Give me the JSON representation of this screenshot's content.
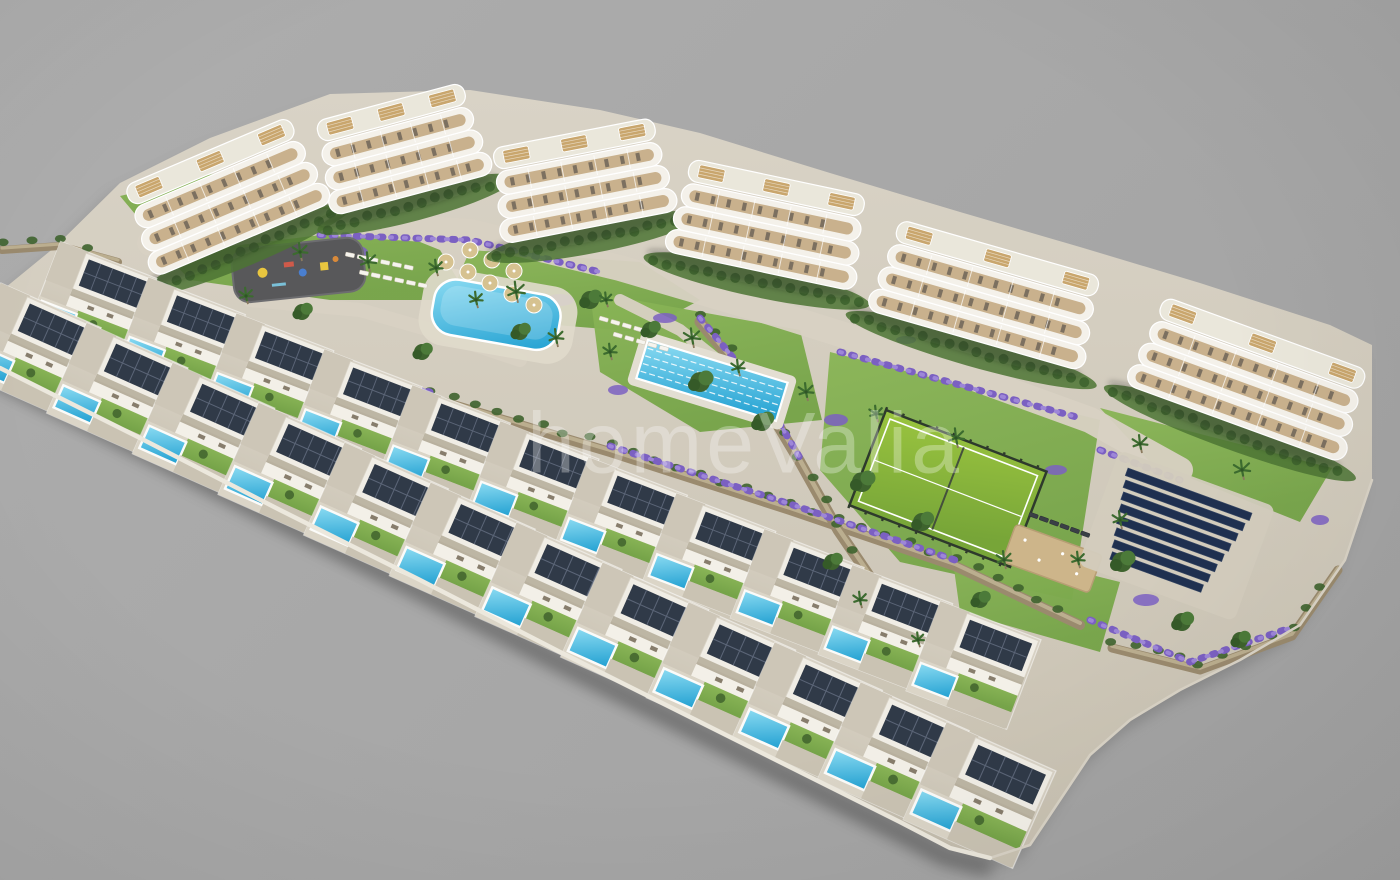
{
  "watermark": {
    "text": "homeValia",
    "color": "#ffffff",
    "opacity": 0.3,
    "x": 745,
    "y": 444,
    "font_size": 86
  },
  "canvas": {
    "width": 1400,
    "height": 880,
    "background": "#a8a8a8"
  },
  "palette": {
    "paving": "#d3ccbe",
    "paving_light": "#ddd7c9",
    "paving_dark": "#c6bfaf",
    "edge_white": "#ece8dd",
    "edge_gray": "#d9d3c6",
    "lawn": "#76a449",
    "lawn_light": "#8ab557",
    "lawn_dark": "#4c7434",
    "tree_dark": "#3e632e",
    "tree_mid": "#4c7a39",
    "tree_deep": "#355a28",
    "wall_stone": "#9a8a6e",
    "wall_hi": "#c3b697",
    "flower_purple": "#7b60c2",
    "flower_purple_light": "#9d86d8",
    "pool_blue": "#2aa5d4",
    "pool_light": "#8bdbf2",
    "building_white": "#f4f1ea",
    "balcony_wood": "#c9b18d",
    "furniture_tick": "#6e6558",
    "roof_deck": "#eae7db",
    "pergola_wood": "#c9a66d",
    "solar_panel": "#303a48",
    "solar_grid": "#5b6577",
    "solar_farm": "#1f3050",
    "playground_surface": "#58585a",
    "padel_green": "#9ac43f",
    "padel_green_dark": "#77a538",
    "padel_fence": "#2e3a2c",
    "petanque_sand": "#cdb58a",
    "path": "#d8d1c3",
    "shadow": "rgba(25,25,25,0.20)"
  },
  "scene": {
    "site_outline": [
      [
        0,
        292
      ],
      [
        55,
        247
      ],
      [
        120,
        183
      ],
      [
        210,
        138
      ],
      [
        330,
        94
      ],
      [
        470,
        90
      ],
      [
        600,
        110
      ],
      [
        700,
        133
      ],
      [
        830,
        173
      ],
      [
        960,
        212
      ],
      [
        1080,
        247
      ],
      [
        1200,
        283
      ],
      [
        1330,
        325
      ],
      [
        1372,
        345
      ],
      [
        1372,
        480
      ],
      [
        1345,
        560
      ],
      [
        1300,
        625
      ],
      [
        1240,
        660
      ],
      [
        1180,
        690
      ],
      [
        1130,
        720
      ],
      [
        1090,
        755
      ],
      [
        1060,
        800
      ],
      [
        1030,
        845
      ],
      [
        990,
        858
      ],
      [
        950,
        848
      ],
      [
        900,
        822
      ],
      [
        820,
        782
      ],
      [
        700,
        722
      ],
      [
        560,
        652
      ],
      [
        420,
        580
      ],
      [
        280,
        510
      ],
      [
        140,
        438
      ],
      [
        0,
        368
      ]
    ],
    "front_edge": [
      [
        0,
        368
      ],
      [
        140,
        438
      ],
      [
        280,
        510
      ],
      [
        420,
        580
      ],
      [
        560,
        652
      ],
      [
        700,
        722
      ],
      [
        820,
        782
      ],
      [
        900,
        822
      ],
      [
        950,
        848
      ],
      [
        990,
        858
      ]
    ],
    "right_edge": [
      [
        990,
        858
      ],
      [
        1030,
        845
      ],
      [
        1060,
        800
      ],
      [
        1090,
        755
      ],
      [
        1130,
        720
      ],
      [
        1180,
        690
      ],
      [
        1240,
        660
      ],
      [
        1300,
        625
      ],
      [
        1345,
        560
      ],
      [
        1372,
        480
      ]
    ],
    "lawns": [
      [
        [
          150,
          238
        ],
        [
          330,
          206
        ],
        [
          440,
          250
        ],
        [
          470,
          300
        ],
        [
          330,
          300
        ],
        [
          190,
          280
        ]
      ],
      [
        [
          470,
          250
        ],
        [
          640,
          262
        ],
        [
          700,
          300
        ],
        [
          640,
          332
        ],
        [
          520,
          322
        ],
        [
          450,
          296
        ]
      ],
      [
        [
          590,
          292
        ],
        [
          800,
          330
        ],
        [
          822,
          420
        ],
        [
          700,
          432
        ],
        [
          600,
          372
        ]
      ],
      [
        [
          830,
          352
        ],
        [
          1100,
          420
        ],
        [
          1072,
          600
        ],
        [
          900,
          562
        ],
        [
          820,
          470
        ]
      ],
      [
        [
          950,
          540
        ],
        [
          1120,
          582
        ],
        [
          1100,
          652
        ],
        [
          960,
          612
        ]
      ],
      [
        [
          1100,
          408
        ],
        [
          1332,
          468
        ],
        [
          1300,
          522
        ],
        [
          1150,
          462
        ]
      ],
      [
        [
          120,
          196
        ],
        [
          230,
          170
        ],
        [
          300,
          200
        ],
        [
          230,
          240
        ],
        [
          150,
          232
        ]
      ]
    ],
    "paths": [
      {
        "pts": [
          [
            150,
            243
          ],
          [
            320,
            222
          ],
          [
            470,
            232
          ],
          [
            620,
            268
          ],
          [
            770,
            312
          ],
          [
            930,
            362
          ],
          [
            1090,
            420
          ],
          [
            1180,
            470
          ]
        ],
        "w": 26
      },
      {
        "pts": [
          [
            250,
            300
          ],
          [
            360,
            310
          ],
          [
            430,
            330
          ],
          [
            520,
            360
          ]
        ],
        "w": 14
      },
      {
        "pts": [
          [
            620,
            300
          ],
          [
            680,
            330
          ],
          [
            730,
            370
          ]
        ],
        "w": 12
      }
    ],
    "walls": [
      {
        "pts": [
          [
            58,
            296
          ],
          [
            240,
            350
          ],
          [
            430,
            398
          ],
          [
            610,
            452
          ],
          [
            790,
            510
          ],
          [
            955,
            566
          ],
          [
            1080,
            625
          ]
        ],
        "w": 10
      },
      {
        "pts": [
          [
            700,
            322
          ],
          [
            758,
            392
          ],
          [
            800,
            462
          ],
          [
            838,
            530
          ],
          [
            872,
            580
          ]
        ],
        "w": 11
      },
      {
        "pts": [
          [
            1112,
            648
          ],
          [
            1200,
            670
          ],
          [
            1292,
            636
          ],
          [
            1338,
            570
          ]
        ],
        "w": 9
      },
      {
        "pts": [
          [
            2,
            250
          ],
          [
            60,
            246
          ],
          [
            118,
            262
          ]
        ],
        "w": 8
      }
    ],
    "flower_strips": [
      [
        [
          320,
          235
        ],
        [
          470,
          240
        ],
        [
          600,
          272
        ]
      ],
      [
        [
          58,
          290
        ],
        [
          240,
          344
        ],
        [
          430,
          392
        ]
      ],
      [
        [
          610,
          446
        ],
        [
          790,
          504
        ],
        [
          955,
          560
        ]
      ],
      [
        [
          700,
          318
        ],
        [
          760,
          390
        ],
        [
          800,
          458
        ]
      ],
      [
        [
          840,
          352
        ],
        [
          1080,
          418
        ]
      ],
      [
        [
          1090,
          620
        ],
        [
          1190,
          662
        ],
        [
          1290,
          628
        ]
      ],
      [
        [
          1100,
          450
        ],
        [
          1180,
          480
        ]
      ]
    ],
    "purple_blobs": [
      [
        352,
        252,
        16,
        7
      ],
      [
        560,
        300,
        14,
        6
      ],
      [
        665,
        318,
        12,
        5
      ],
      [
        618,
        390,
        10,
        5
      ],
      [
        836,
        420,
        12,
        6
      ],
      [
        1056,
        470,
        11,
        5
      ],
      [
        1146,
        600,
        13,
        6
      ],
      [
        238,
        330,
        10,
        5
      ],
      [
        906,
        340,
        10,
        4
      ],
      [
        1320,
        520,
        9,
        5
      ]
    ],
    "buildings": [
      {
        "cx": 228,
        "cy": 203,
        "len": 195,
        "rot": -23
      },
      {
        "cx": 403,
        "cy": 156,
        "len": 168,
        "rot": -15
      },
      {
        "cx": 583,
        "cy": 188,
        "len": 180,
        "rot": -11
      },
      {
        "cx": 767,
        "cy": 232,
        "len": 195,
        "rot": 12
      },
      {
        "cx": 985,
        "cy": 302,
        "len": 225,
        "rot": 16
      },
      {
        "cx": 1247,
        "cy": 386,
        "len": 232,
        "rot": 20
      }
    ],
    "villa_rows": [
      {
        "start": [
          62,
          248
        ],
        "step": [
          88,
          36
        ],
        "count": 11,
        "rot": 21,
        "scale": 0.94,
        "scale_step": 0.004
      },
      {
        "start": [
          2,
          290
        ],
        "step": [
          86,
          40
        ],
        "count": 12,
        "rot": 24,
        "scale": 1.0,
        "scale_step": 0.008
      }
    ],
    "amenities": {
      "playground": {
        "x": 230,
        "y": 250,
        "w": 132,
        "h": 54,
        "rot": -6,
        "items": [
          {
            "t": "c",
            "dx": 30,
            "dy": 26,
            "r": 5,
            "color": "#e9c63f"
          },
          {
            "t": "r",
            "dx": 52,
            "dy": 18,
            "w": 10,
            "h": 5,
            "color": "#cf5a4a"
          },
          {
            "t": "c",
            "dx": 70,
            "dy": 30,
            "r": 4,
            "color": "#4a7fd0"
          },
          {
            "t": "r",
            "dx": 88,
            "dy": 22,
            "w": 8,
            "h": 8,
            "color": "#e9c63f"
          },
          {
            "t": "c",
            "dx": 104,
            "dy": 20,
            "r": 3,
            "color": "#d98a3a"
          },
          {
            "t": "r",
            "dx": 38,
            "dy": 38,
            "w": 14,
            "h": 3,
            "color": "#7ac0d8"
          }
        ]
      },
      "lagoon_pool": {
        "x": 438,
        "y": 276,
        "w": 128,
        "h": 56,
        "rot": 10
      },
      "lap_pool": {
        "x": 648,
        "y": 340,
        "w": 146,
        "h": 40,
        "rot": 17,
        "lanes": 5
      },
      "padel_court": {
        "x": 886,
        "y": 410,
        "w": 172,
        "h": 102,
        "rot": 21
      },
      "petanque": {
        "x": 1016,
        "y": 524,
        "w": 92,
        "h": 40,
        "rot": 20
      },
      "solar_field": {
        "x": 1128,
        "y": 468,
        "rot": 20,
        "rows": 8,
        "row_w": 132,
        "row_h": 8,
        "gap": 12
      }
    },
    "umbrellas": [
      [
        446,
        262
      ],
      [
        468,
        272
      ],
      [
        490,
        283
      ],
      [
        512,
        294
      ],
      [
        534,
        305
      ],
      [
        470,
        250
      ],
      [
        492,
        260
      ],
      [
        514,
        271
      ]
    ],
    "lounger_rows": [
      {
        "x": 346,
        "y": 252,
        "rot": 12,
        "count": 6,
        "dx": 12
      },
      {
        "x": 360,
        "y": 270,
        "rot": 12,
        "count": 6,
        "dx": 12
      },
      {
        "x": 600,
        "y": 316,
        "rot": 16,
        "count": 5,
        "dx": 12
      },
      {
        "x": 614,
        "y": 332,
        "rot": 16,
        "count": 5,
        "dx": 12
      },
      {
        "x": 1030,
        "y": 512,
        "rot": 20,
        "count": 6,
        "dx": 11,
        "dark": true
      }
    ],
    "palms": [
      [
        300,
        252,
        1
      ],
      [
        368,
        262,
        1.1
      ],
      [
        436,
        268,
        0.9
      ],
      [
        516,
        292,
        1.2
      ],
      [
        556,
        338,
        1
      ],
      [
        610,
        352,
        0.9
      ],
      [
        692,
        338,
        1.1
      ],
      [
        738,
        368,
        0.9
      ],
      [
        806,
        392,
        1
      ],
      [
        876,
        414,
        0.9
      ],
      [
        956,
        438,
        1.1
      ],
      [
        1004,
        560,
        1
      ],
      [
        1078,
        560,
        0.9
      ],
      [
        1120,
        520,
        1
      ],
      [
        606,
        300,
        0.8
      ],
      [
        476,
        300,
        0.9
      ],
      [
        246,
        296,
        0.9
      ],
      [
        1140,
        444,
        1
      ],
      [
        1242,
        470,
        1.1
      ],
      [
        860,
        600,
        0.9
      ],
      [
        918,
        640,
        0.8
      ]
    ],
    "trees": [
      [
        590,
        300,
        9
      ],
      [
        650,
        330,
        8
      ],
      [
        700,
        382,
        10
      ],
      [
        762,
        422,
        9
      ],
      [
        520,
        332,
        8
      ],
      [
        862,
        482,
        10
      ],
      [
        922,
        522,
        9
      ],
      [
        832,
        562,
        8
      ],
      [
        1122,
        562,
        10
      ],
      [
        1182,
        622,
        9
      ],
      [
        302,
        312,
        8
      ],
      [
        422,
        352,
        8
      ],
      [
        980,
        600,
        8
      ],
      [
        1240,
        640,
        8
      ]
    ]
  }
}
